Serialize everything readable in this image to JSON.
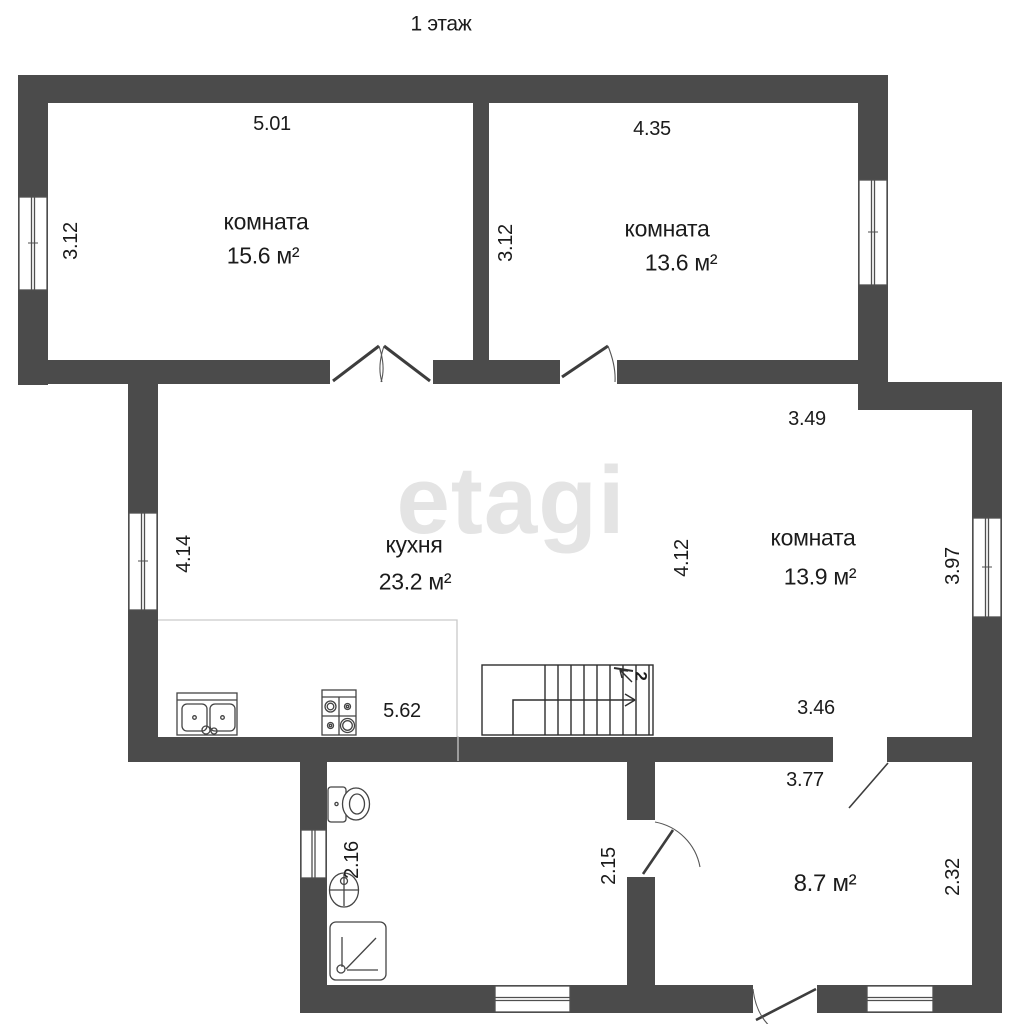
{
  "title": "1 этаж",
  "watermark": "etagi",
  "colors": {
    "wall": "#4b4b4b",
    "text": "#1b1b1b",
    "watermark": "#e4e4e4"
  },
  "stairs": {
    "floor_label": "2"
  },
  "rooms": {
    "room_tl": {
      "name": "комната",
      "area": "15.6 м²",
      "dim_top": "5.01",
      "dim_left": "3.12"
    },
    "room_tr": {
      "name": "комната",
      "area": "13.6 м²",
      "dim_top": "4.35",
      "dim_left": "3.12"
    },
    "kitchen": {
      "name": "кухня",
      "area": "23.2 м²",
      "dim_left": "4.14",
      "dim_bottom": "5.62"
    },
    "room_mid": {
      "name": "комната",
      "area": "13.9 м²",
      "dim_top": "3.49",
      "dim_left": "4.12",
      "dim_right": "3.97",
      "dim_bottom": "3.46"
    },
    "bathroom": {
      "dim_left": "2.16",
      "dim_right": "2.15"
    },
    "hall": {
      "area": "8.7 м²",
      "dim_top": "3.77",
      "dim_right": "2.32"
    }
  }
}
